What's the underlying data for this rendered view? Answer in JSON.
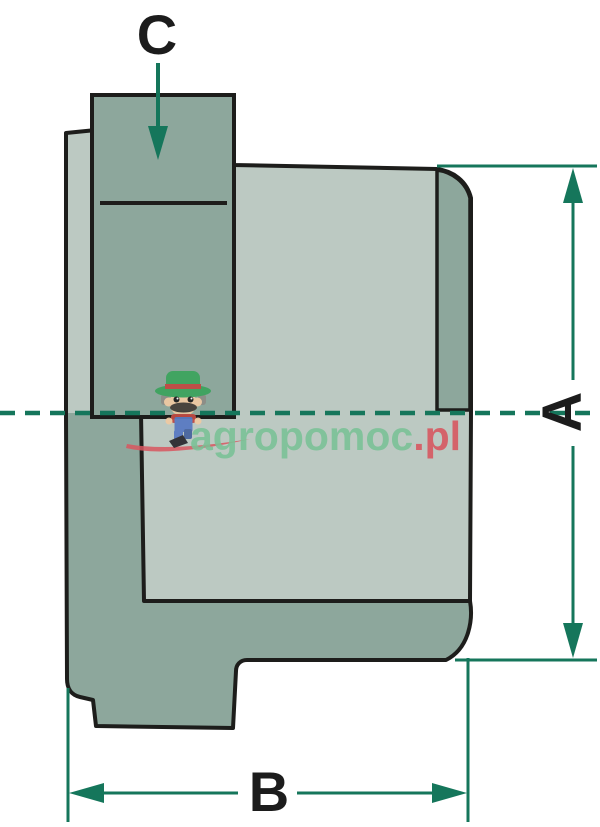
{
  "diagram": {
    "type": "technical-drawing-cross-section",
    "dimension_labels": {
      "a": "A",
      "b": "B",
      "c": "C"
    },
    "watermark": {
      "brand_green": "agropomoc",
      "brand_red": ".pl"
    },
    "colors": {
      "part-dark": "#8da79c",
      "part-light": "#bcc9c2",
      "outline": "#1d1d1b",
      "dimension": "#15765b",
      "watermark-green": "#79c296",
      "watermark-red": "#d8565f",
      "label": "#1c1c1c",
      "farmer-hat": "#3da35e",
      "farmer-skin": "#eec9a3",
      "farmer-shirt": "#c04a43",
      "farmer-overalls": "#5a7bc2",
      "farmer-boot": "#2c2c31"
    }
  }
}
